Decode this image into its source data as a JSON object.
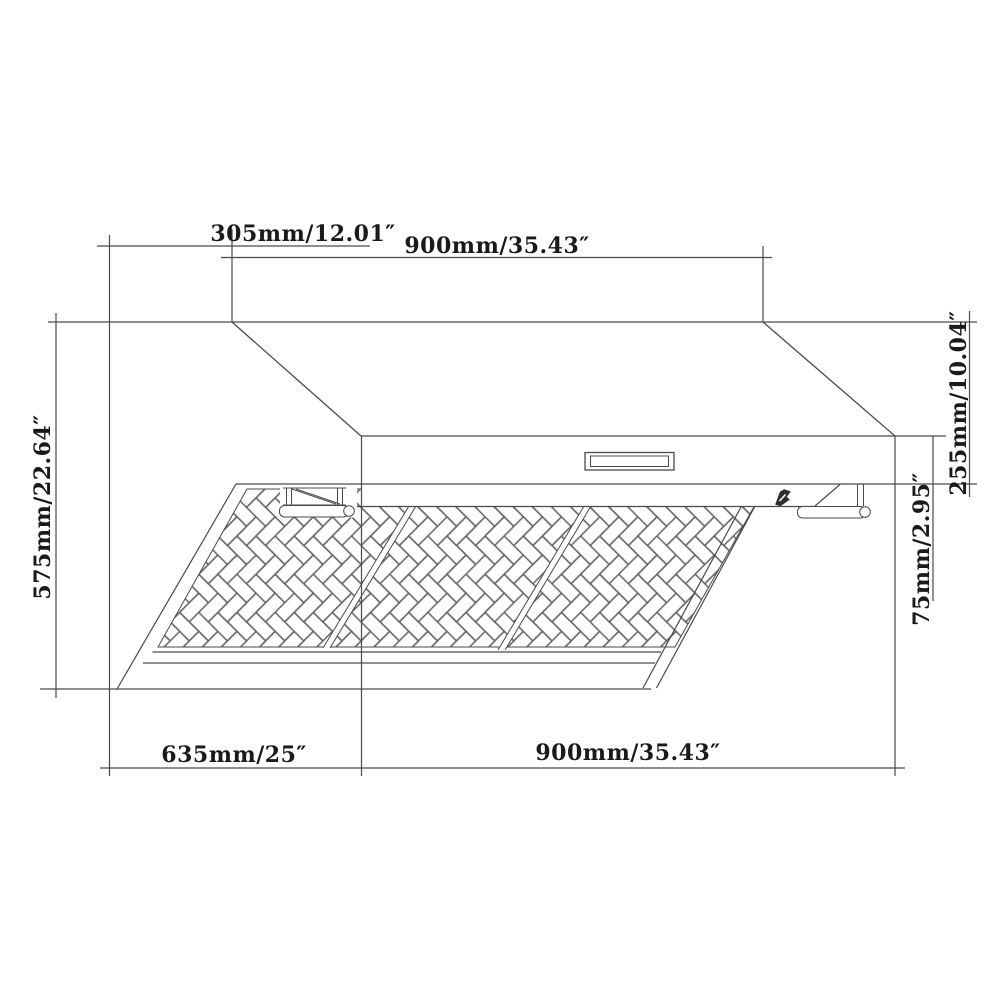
{
  "drawing": {
    "type": "technical-dimension-drawing",
    "subject": "range-hood",
    "colors": {
      "line": "#4a4a4a",
      "detail_line": "#5a5a5a",
      "text": "#1a1a1a",
      "background": "#ffffff"
    },
    "labels": {
      "top_left": "305mm/12.01″",
      "top_right": "900mm/35.43″",
      "left": "575mm/22.64″",
      "right_upper": "255mm/10.04″",
      "right_lower": "75mm/2.95″",
      "bottom_left": "635mm/25″",
      "bottom_right": "900mm/35.43″"
    }
  }
}
